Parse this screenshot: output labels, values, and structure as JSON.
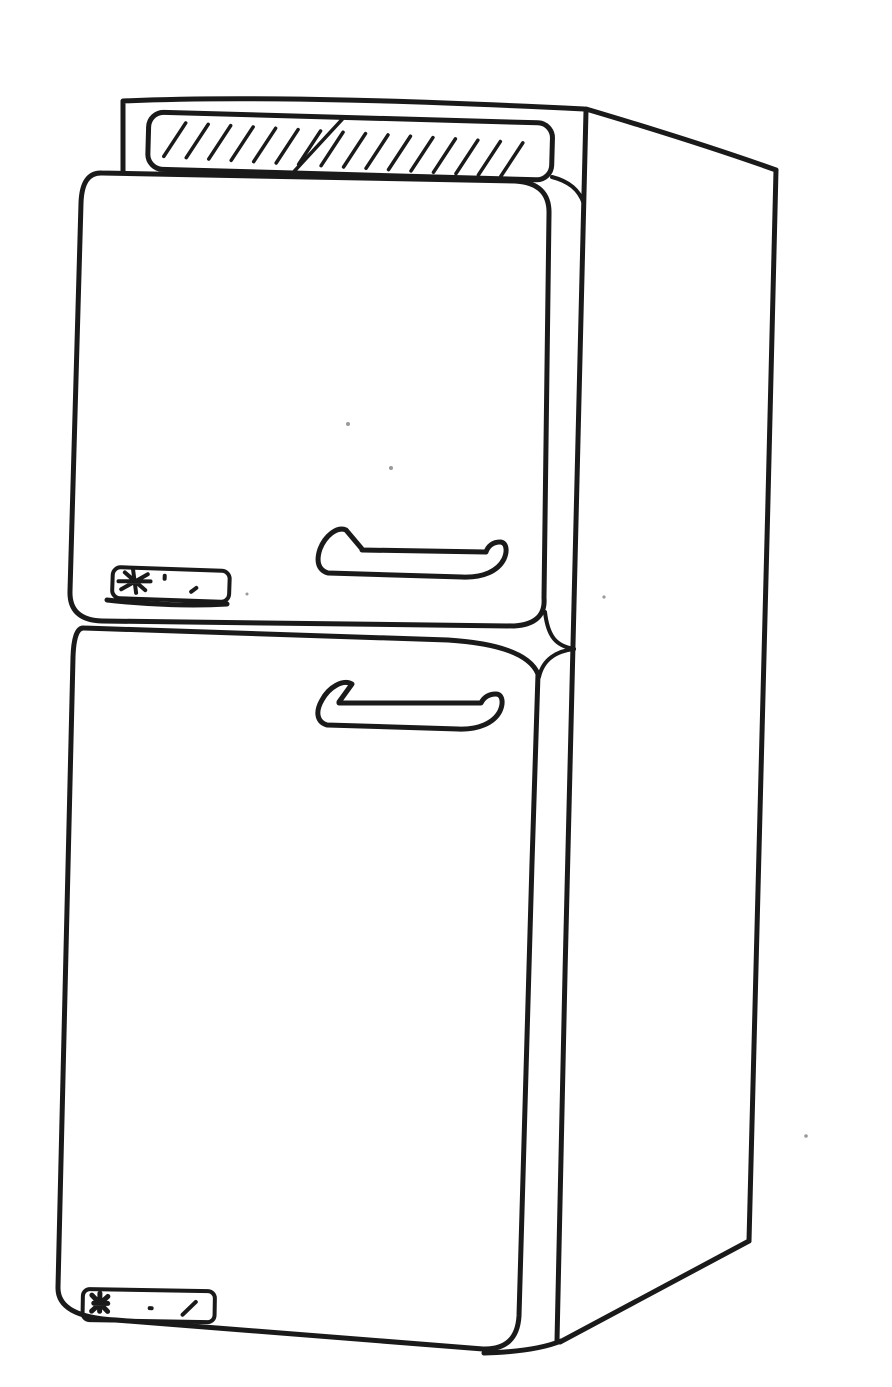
{
  "figure": {
    "subject": "top-freezer refrigerator",
    "description": "Black-and-white hand-drawn line illustration of a two-door top-freezer refrigerator in three-quarter view, right side panel visible, hatched vent grille panel on top, horizontal bar handles and small unreadable nameplate badges on both doors",
    "ink_color": "#1a1a1a",
    "paper_color": "#ffffff",
    "grille": {
      "hatch_count": 16
    },
    "parts": [
      {
        "name": "top-vent-grille",
        "label": "hatched top vent panel"
      },
      {
        "name": "freezer-door",
        "label": "upper freezer door"
      },
      {
        "name": "freezer-door-handle",
        "label": "freezer door bar handle"
      },
      {
        "name": "freezer-nameplate",
        "label": "freezer door nameplate badge with scribbled logo"
      },
      {
        "name": "refrigerator-door",
        "label": "lower refrigerator door"
      },
      {
        "name": "refrigerator-door-handle",
        "label": "refrigerator door bar handle"
      },
      {
        "name": "refrigerator-nameplate",
        "label": "refrigerator door nameplate badge with scribbled logo"
      },
      {
        "name": "cabinet-side-panel",
        "label": "cabinet right side panel in perspective"
      }
    ]
  }
}
